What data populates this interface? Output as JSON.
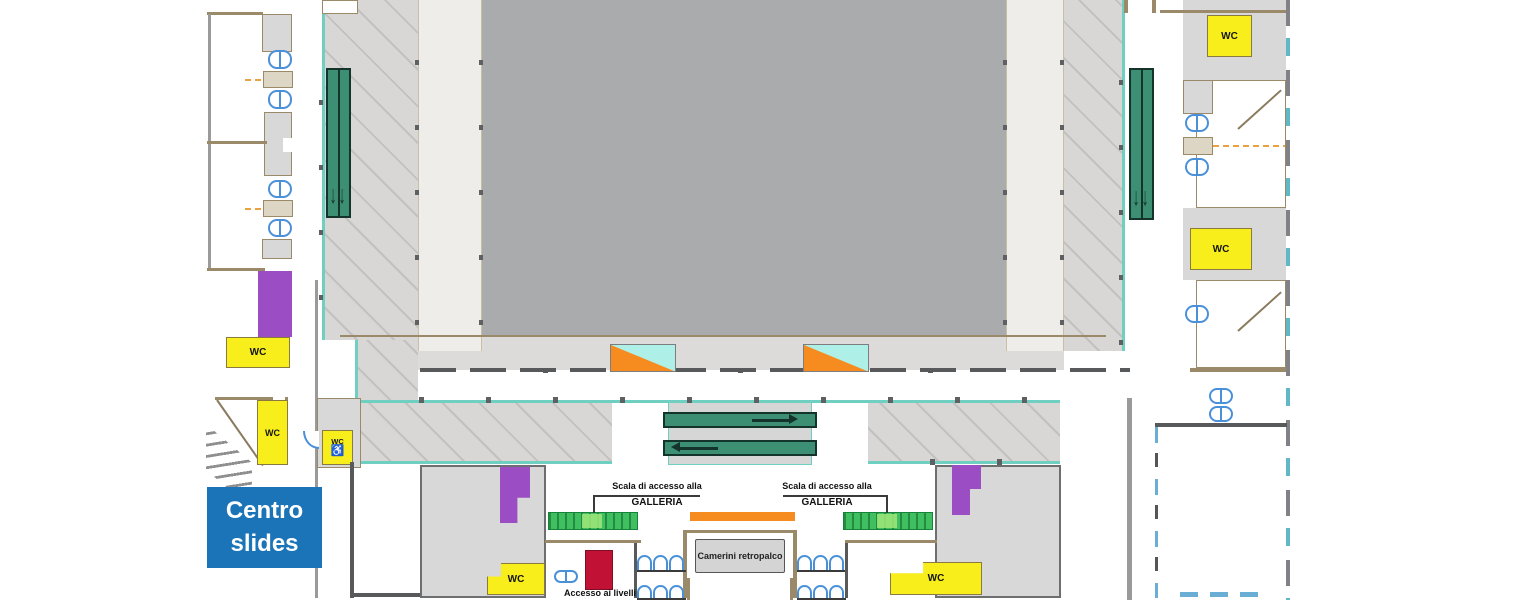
{
  "badge": {
    "line1": "Centro",
    "line2": "slides"
  },
  "labels": {
    "wc": "WC",
    "wheelchair_icon": "♿",
    "down_arrows": "↓↓",
    "gallery_stairs_line1": "Scala di accesso alla",
    "gallery_stairs_line2": "GALLERIA",
    "backstage_rooms": "Camerini retropalco",
    "level_access": "Accesso ai livelli"
  },
  "colors": {
    "stage_gray": "#a9abad",
    "walkway_gray": "#dcdbd9",
    "corridor_hatch": "#d8d7d5",
    "hatch_line": "#c2c1bf",
    "strip_cream": "#eeedea",
    "room_gray": "#d8d8d8",
    "wall_tan": "#9a8a6a",
    "wall_dark": "#58595b",
    "wall_gray": "#9a9a98",
    "teal": "#6fcfc0",
    "door_blue": "#4a90d9",
    "escalator_green": "#3c8f72",
    "escalator_border": "#14332a",
    "stair_green": "#3fbf5f",
    "stair_green_dark": "#17833a",
    "stair_green_light": "#9fe77a",
    "wc_yellow": "#f8ee1c",
    "wc_border": "#8a7a40",
    "purple": "#9b4dc3",
    "orange": "#f68b1f",
    "red": "#c11236",
    "badge_blue": "#1b74b8",
    "triangle_cyan": "#aef0e8",
    "leader_dark": "#3a3a3a"
  }
}
